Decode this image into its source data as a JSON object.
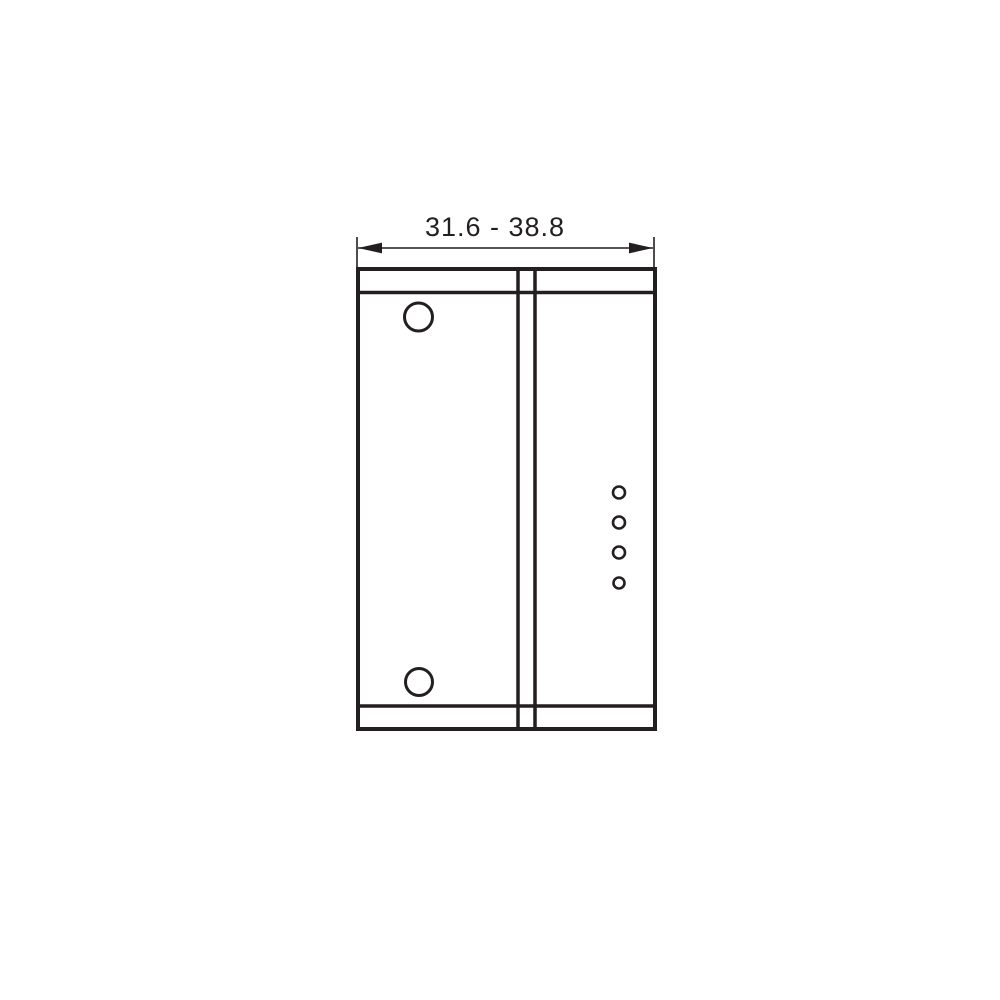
{
  "drawing": {
    "dimension_label": "31.6 - 38.8",
    "line_color": "#231f20",
    "background_color": "#ffffff"
  }
}
